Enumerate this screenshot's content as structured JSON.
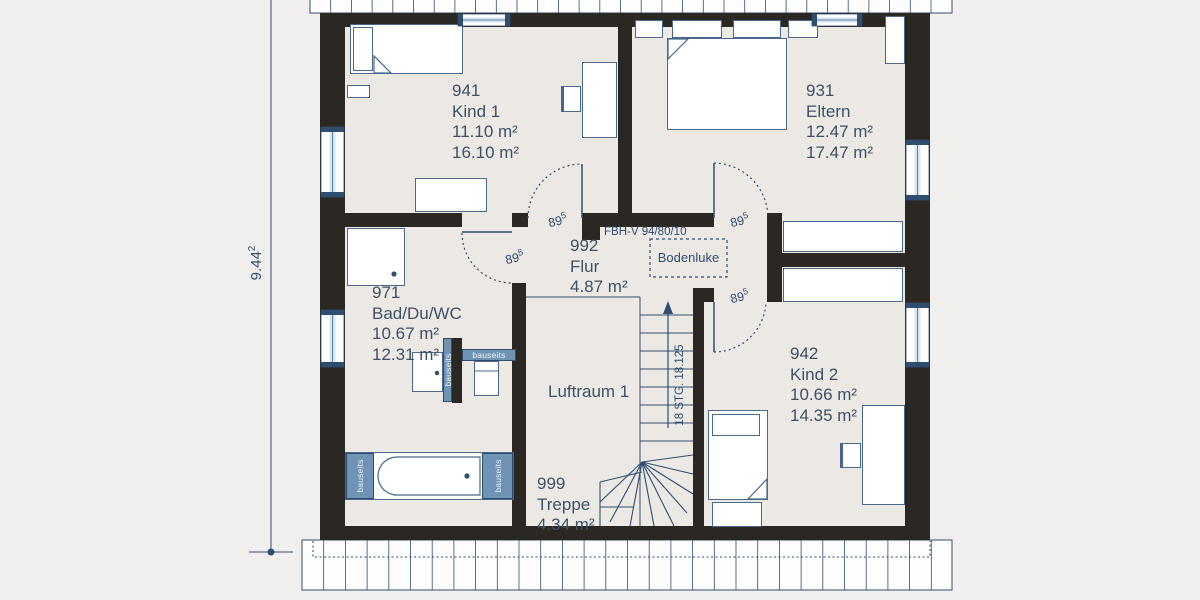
{
  "plan": {
    "dimension": {
      "value": "9.44",
      "sup": "2"
    },
    "door_label": {
      "value": "89",
      "sup": "5"
    },
    "fbh_label": "FBH-V 94/80/10",
    "bodenluke_label": "Bodenluke",
    "luftraum_label": "Luftraum 1",
    "stair_label": "18 STG. 18.125",
    "bauseits_label": "bauseits",
    "rooms": {
      "kind1": {
        "id": "941",
        "name": "Kind 1",
        "area1": "11.10 m²",
        "area2": "16.10 m²"
      },
      "eltern": {
        "id": "931",
        "name": "Eltern",
        "area1": "12.47 m²",
        "area2": "17.47 m²"
      },
      "flur": {
        "id": "992",
        "name": "Flur",
        "area1": "4.87 m²"
      },
      "bad": {
        "id": "971",
        "name": "Bad/Du/WC",
        "area1": "10.67 m²",
        "area2": "12.31 m²"
      },
      "kind2": {
        "id": "942",
        "name": "Kind 2",
        "area1": "10.66 m²",
        "area2": "14.35 m²"
      },
      "treppe": {
        "id": "999",
        "name": "Treppe",
        "area1": "4.34 m²"
      }
    },
    "colors": {
      "wall": "#2b2723",
      "line": "#2f4e70",
      "text": "#3d5166",
      "accent_bar": "#6f93b5",
      "background": "#f0efed",
      "room_fill": "#ece9e5"
    }
  }
}
